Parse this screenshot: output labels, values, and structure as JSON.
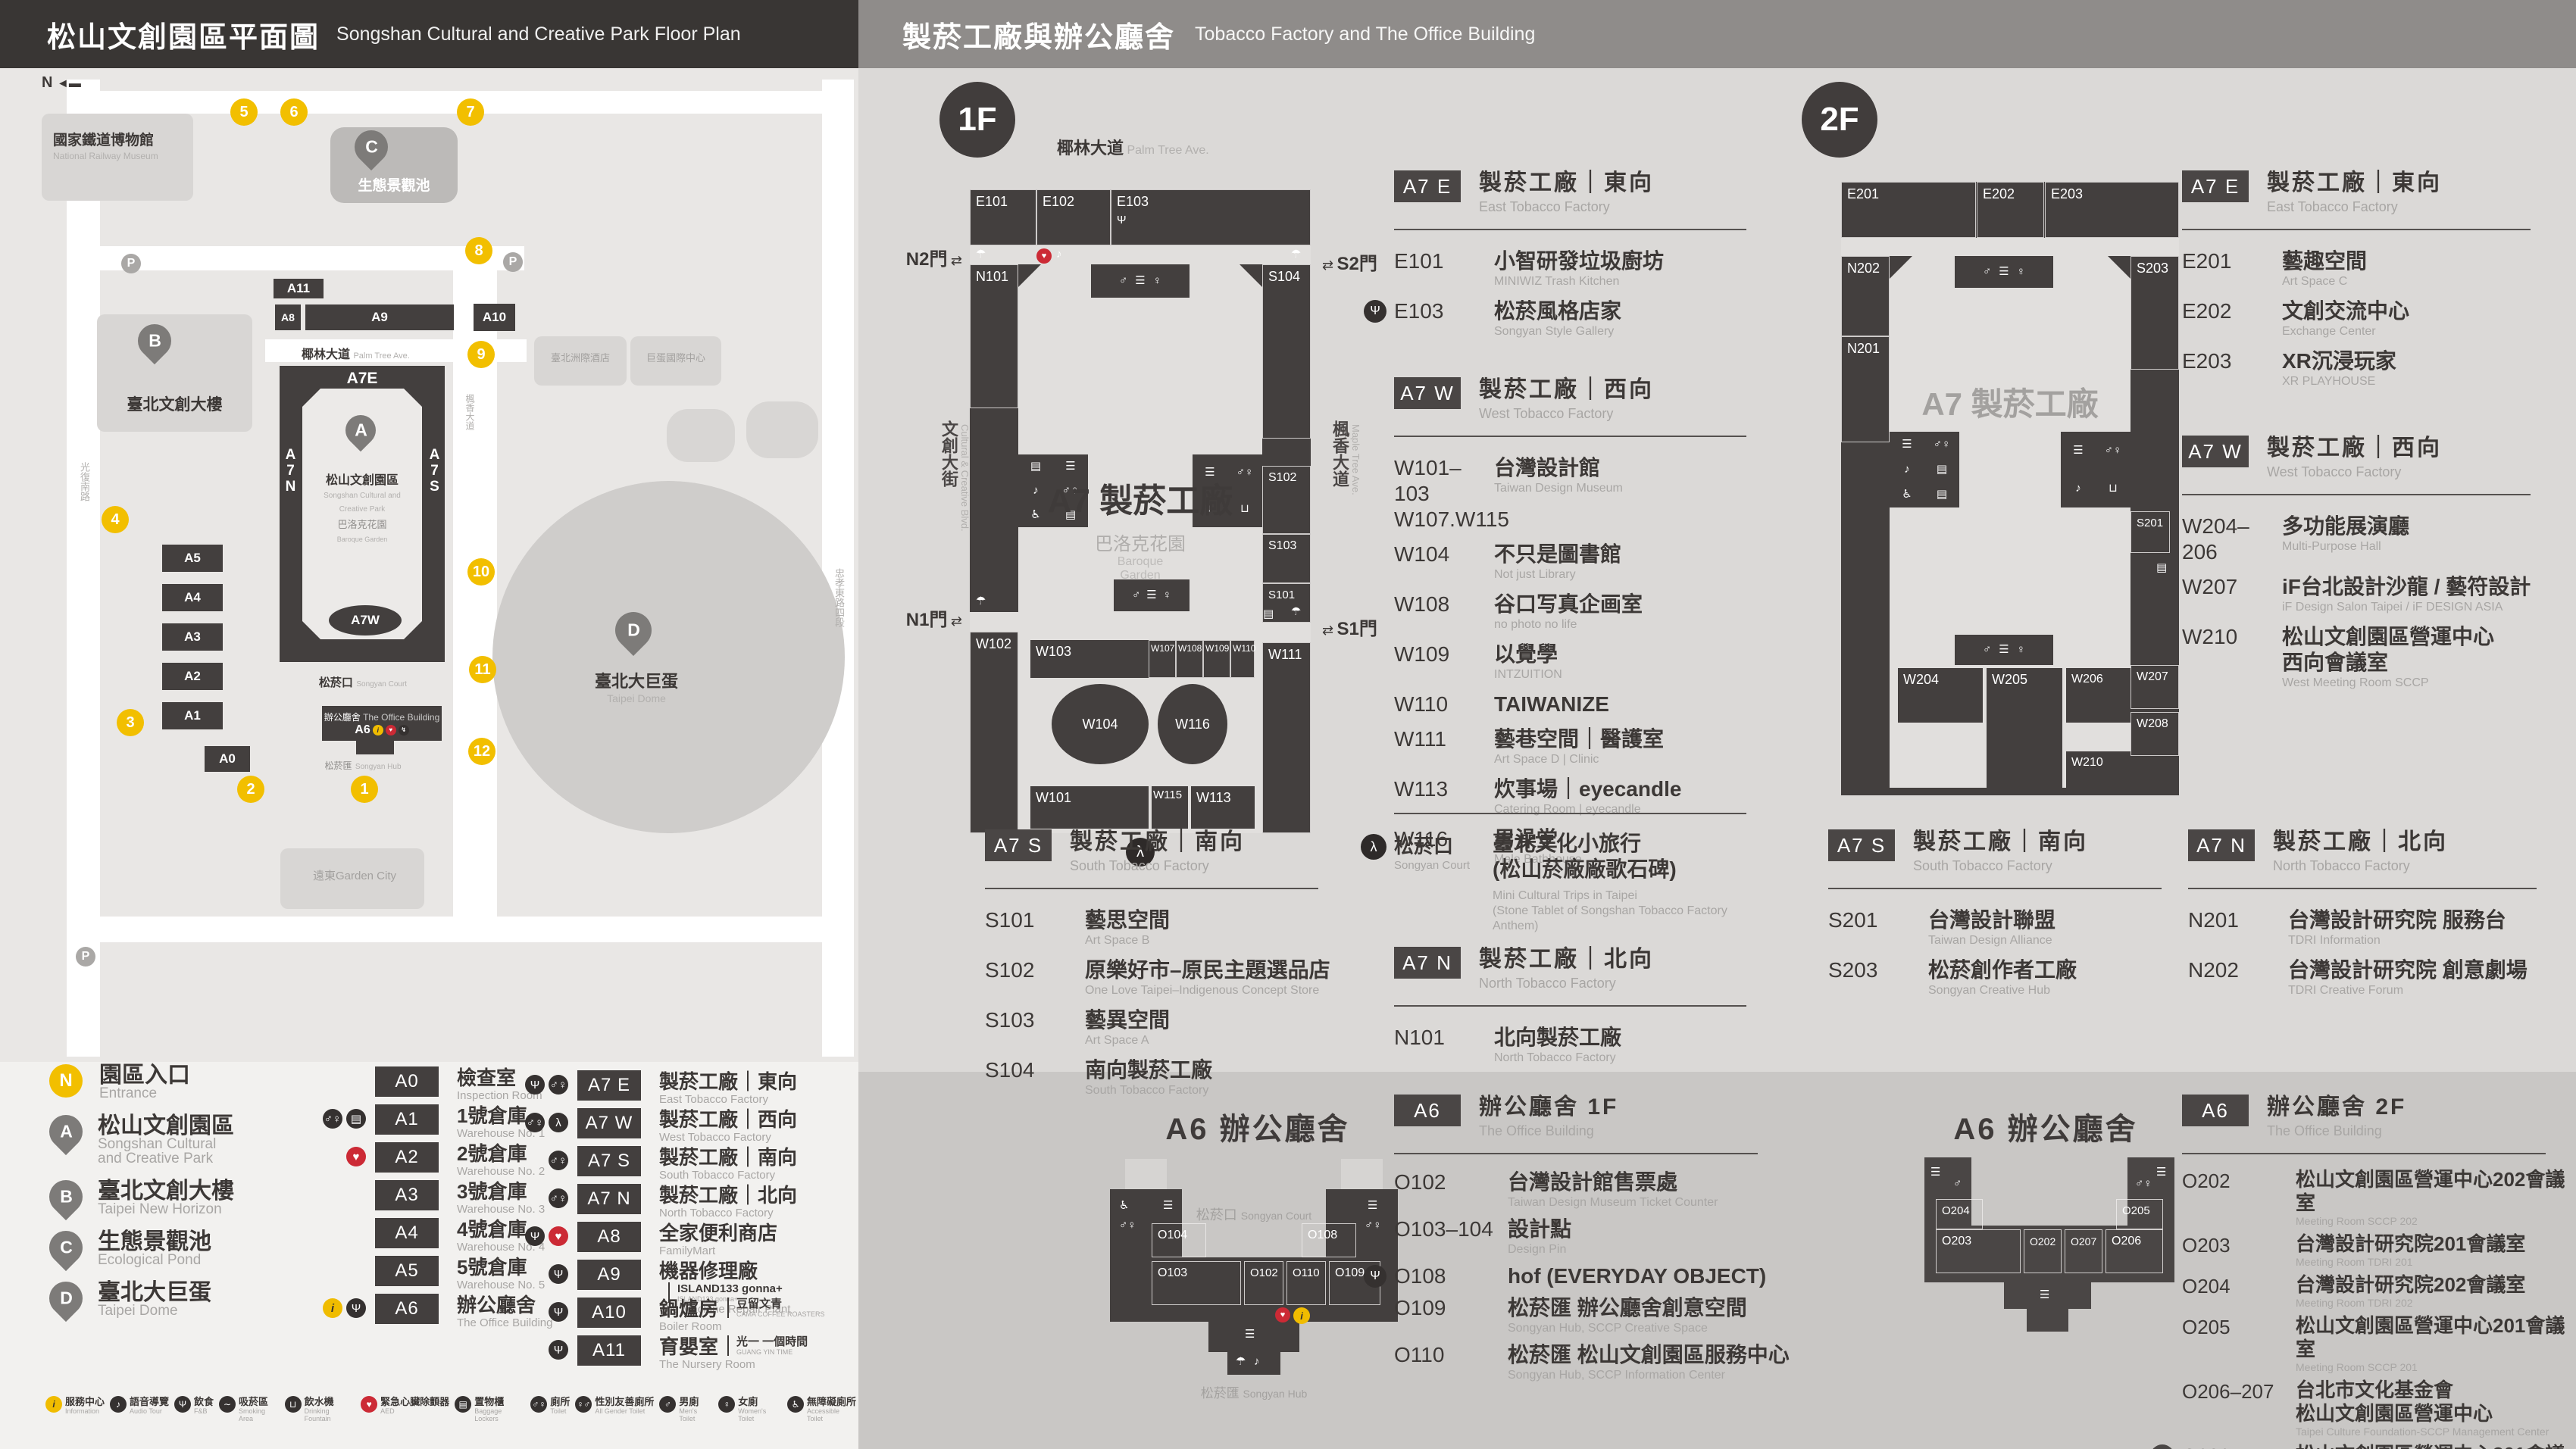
{
  "header_left": {
    "title_zh": "松山文創園區平面圖",
    "title_en": "Songshan Cultural and Creative Park Floor Plan"
  },
  "header_right": {
    "title_zh": "製菸工廠與辦公廳舍",
    "title_en": "Tobacco Factory and The Office Building"
  },
  "colors": {
    "dark": "#433f3e",
    "panel": "#dbd9d7",
    "panel_dark": "#c9c7c5",
    "yellow": "#f2bf00",
    "red": "#cc2a35",
    "header_right": "#8f8c8a"
  },
  "park_map": {
    "compass": "N",
    "railway_zh": "國家鐵道博物館",
    "railway_en": "National Railway Museum",
    "streets": {
      "palm_zh": "椰林大道",
      "palm_en": "Palm Tree Ave.",
      "guangfu": "光復南路",
      "zhongxiao": "忠孝東路四段",
      "maple_zh": "楓香大道",
      "maple_en": "Maple Tree Ave."
    },
    "blocks": {
      "a11": "A11",
      "a8": "A8",
      "a9": "A9",
      "a10": "A10",
      "a7e": "A7E",
      "a7w": "A7W",
      "a7n": "A7N",
      "a7s": "A7S",
      "a5": "A5",
      "a4": "A4",
      "a3": "A3",
      "a2": "A2",
      "a1": "A1",
      "a0": "A0",
      "a6": "A6"
    },
    "pond_label": "生態景觀池",
    "b_label": "臺北文創大樓",
    "a_label_zh": "松山文創園區",
    "a_label_en": "Songshan Cultural and\nCreative Park",
    "garden_zh": "巴洛克花園",
    "garden_en": "Baroque Garden",
    "court_zh": "松菸口",
    "court_en": "Songyan Court",
    "office_zh": "辦公廳舍",
    "office_en": "The Office Building",
    "hub_zh": "松菸匯",
    "hub_en": "Songyan Hub",
    "dome_zh": "臺北大巨蛋",
    "dome_en": "Taipei Dome",
    "hotel1": "臺北洲際酒店",
    "hotel2": "巨蛋國際中心",
    "garden_city": "遠東Garden City",
    "pins": {
      "a": "A",
      "b": "B",
      "c": "C",
      "d": "D"
    },
    "entrances": [
      "1",
      "2",
      "3",
      "4",
      "5",
      "6",
      "7",
      "8",
      "9",
      "10",
      "11",
      "12"
    ]
  },
  "legend": {
    "entrance": {
      "symbol": "N",
      "zh": "園區入口",
      "en": "Entrance"
    },
    "places": [
      {
        "pin": "A",
        "zh": "松山文創園區",
        "en": "Songshan Cultural\nand Creative Park"
      },
      {
        "pin": "B",
        "zh": "臺北文創大樓",
        "en": "Taipei New Horizon"
      },
      {
        "pin": "C",
        "zh": "生態景觀池",
        "en": "Ecological Pond"
      },
      {
        "pin": "D",
        "zh": "臺北大巨蛋",
        "en": "Taipei Dome"
      }
    ],
    "col1": [
      {
        "badge": "A0",
        "zh": "檢查室",
        "en": "Inspection Room",
        "icons": []
      },
      {
        "badge": "A1",
        "zh": "1號倉庫",
        "en": "Warehouse No. 1",
        "icons": [
          {
            "g": "▤",
            "c": "dark"
          },
          {
            "g": "♂♀",
            "c": "dark"
          }
        ]
      },
      {
        "badge": "A2",
        "zh": "2號倉庫",
        "en": "Warehouse No. 2",
        "icons": [
          {
            "g": "♥",
            "c": "red"
          }
        ]
      },
      {
        "badge": "A3",
        "zh": "3號倉庫",
        "en": "Warehouse No. 3",
        "icons": []
      },
      {
        "badge": "A4",
        "zh": "4號倉庫",
        "en": "Warehouse No. 4",
        "icons": []
      },
      {
        "badge": "A5",
        "zh": "5號倉庫",
        "en": "Warehouse No. 5",
        "icons": []
      },
      {
        "badge": "A6",
        "zh": "辦公廳舍",
        "en": "The Office Building",
        "icons": [
          {
            "g": "Ψ",
            "c": "dark"
          },
          {
            "g": "i",
            "c": "yellow"
          }
        ]
      }
    ],
    "col2": [
      {
        "badge": "A7 E",
        "zh": "製菸工廠｜東向",
        "en": "East Tobacco Factory",
        "icons": [
          {
            "g": "♂♀",
            "c": "dark"
          },
          {
            "g": "Ψ",
            "c": "dark"
          }
        ]
      },
      {
        "badge": "A7 W",
        "zh": "製菸工廠｜西向",
        "en": "West Tobacco Factory",
        "icons": [
          {
            "g": "λ",
            "c": "dark"
          },
          {
            "g": "♂♀",
            "c": "dark"
          }
        ]
      },
      {
        "badge": "A7 S",
        "zh": "製菸工廠｜南向",
        "en": "South Tobacco Factory",
        "icons": [
          {
            "g": "♂♀",
            "c": "dark"
          }
        ]
      },
      {
        "badge": "A7 N",
        "zh": "製菸工廠｜北向",
        "en": "North Tobacco Factory",
        "icons": [
          {
            "g": "♂♀",
            "c": "dark"
          }
        ]
      },
      {
        "badge": "A8",
        "zh": "全家便利商店",
        "en": "FamilyMart",
        "icons": [
          {
            "g": "♥",
            "c": "red"
          },
          {
            "g": "Ψ",
            "c": "dark"
          }
        ]
      },
      {
        "badge": "A9",
        "zh": "機器修理廠",
        "en": "The Machine Repair Plant",
        "brand_zh": "ISLAND133 gonna+",
        "brand_en": "ISLAND133 gonna+",
        "icons": [
          {
            "g": "Ψ",
            "c": "dark"
          }
        ]
      },
      {
        "badge": "A10",
        "zh": "鍋爐房",
        "en": "Boiler Room",
        "brand_zh": "豆留文青",
        "brand_en": "CAMA COFFEE ROASTERS",
        "icons": [
          {
            "g": "Ψ",
            "c": "dark"
          }
        ]
      },
      {
        "badge": "A11",
        "zh": "育嬰室",
        "en": "The Nursery Room",
        "brand_zh": "光一 一個時間",
        "brand_en": "GUANG YIN TIME",
        "icons": [
          {
            "g": "Ψ",
            "c": "dark"
          }
        ]
      }
    ]
  },
  "amenities_left": [
    {
      "zh": "服務中心",
      "en": "Information",
      "g": "i",
      "c": "yellow"
    },
    {
      "zh": "語音導覽",
      "en": "Audio Tour",
      "g": "♪",
      "c": "dark"
    },
    {
      "zh": "飲食",
      "en": "F&B",
      "g": "Ψ",
      "c": "dark"
    },
    {
      "zh": "吸菸區",
      "en": "Smoking Area",
      "g": "∼",
      "c": "dark"
    },
    {
      "zh": "飲水機",
      "en": "Drinking Fountain",
      "g": "⊔",
      "c": "dark"
    },
    {
      "zh": "緊急心臟除顫器",
      "en": "AED",
      "g": "♥",
      "c": "red"
    },
    {
      "zh": "置物櫃",
      "en": "Baggage Lockers",
      "g": "▤",
      "c": "dark"
    },
    {
      "zh": "廁所",
      "en": "Toilet",
      "g": "♂♀",
      "c": "dark"
    },
    {
      "zh": "性別友善廁所",
      "en": "All Gender Toilet",
      "g": "♀♂",
      "c": "dark"
    },
    {
      "zh": "男廁",
      "en": "Men's Toilet",
      "g": "♂",
      "c": "dark"
    },
    {
      "zh": "女廁",
      "en": "Women's Toilet",
      "g": "♀",
      "c": "dark"
    },
    {
      "zh": "無障礙廁所",
      "en": "Accessible Toilet",
      "g": "♿",
      "c": "dark"
    }
  ],
  "amenities_right": [
    {
      "zh": "哺集乳室",
      "en": "Breastfeeding Room",
      "g": "♡",
      "c": "dark"
    },
    {
      "zh": "共享行動電源",
      "en": "Power Bank Rental",
      "g": "↯",
      "c": "dark"
    },
    {
      "zh": "共享傘",
      "en": "Umbrella Rental",
      "g": "☂",
      "c": "dark"
    },
    {
      "zh": "階梯",
      "en": "Stairs",
      "g": "☰",
      "c": "dark"
    },
    {
      "zh": "貨梯",
      "en": "Elevator For Goods",
      "g": "▣",
      "c": "dark"
    },
    {
      "zh": "無障礙電梯",
      "en": "Accessible Elevator",
      "g": "♿",
      "c": "dark"
    },
    {
      "zh": "臺北文化小旅行",
      "note": "(松山菸廠廠歌石碑)",
      "en": "Mini Cultural Trips in Taipei\n(Stone Tablet of Songshan Tobacco Factory Anthem)",
      "g": "λ",
      "c": "dark"
    }
  ],
  "floor1": {
    "badge": "1F",
    "map": {
      "street_top_zh": "椰林大道",
      "street_top_en": "Palm Tree Ave.",
      "street_left_zh": "文創大街",
      "street_left_en": "Cultural & Creative Blvd.",
      "street_right_zh": "楓香大道",
      "street_right_en": "Maple Tree Ave.",
      "gates": {
        "n2": "N2門",
        "s2": "S2門",
        "n1": "N1門",
        "s1": "S1門"
      },
      "bld_label": "A7 製菸工廠",
      "garden_zh": "巴洛克花園",
      "garden_en": "Baroque\nGarden",
      "rooms": {
        "e101": "E101",
        "e102": "E102",
        "e103": "E103",
        "n101": "N101",
        "s104": "S104",
        "s103": "S103",
        "s102": "S102",
        "s101": "S101",
        "w101": "W101",
        "w102": "W102",
        "w103": "W103",
        "w104": "W104",
        "w107": "W107",
        "w108": "W108",
        "w109": "W109",
        "w110": "W110",
        "w111": "W111",
        "w113": "W113",
        "w115": "W115",
        "w116": "W116"
      }
    },
    "a7e": {
      "badge": "A7 E",
      "zh": "製菸工廠｜東向",
      "en": "East Tobacco Factory",
      "rooms": [
        {
          "id": "E101",
          "zh": "小智研發垃圾廚坊",
          "en": "MINIWIZ Trash Kitchen"
        },
        {
          "id": "E103",
          "zh": "松菸風格店家",
          "en": "Songyan Style Gallery",
          "pre": "Ψ"
        }
      ]
    },
    "a7w": {
      "badge": "A7 W",
      "zh": "製菸工廠｜西向",
      "en": "West Tobacco Factory",
      "rooms": [
        {
          "id": "W101–103\nW107.W115",
          "zh": "台灣設計館",
          "en": "Taiwan Design Museum"
        },
        {
          "id": "W104",
          "zh": "不只是圖書館",
          "en": "Not just Library"
        },
        {
          "id": "W108",
          "zh": "谷口写真企画室",
          "en": "no photo no life"
        },
        {
          "id": "W109",
          "zh": "以覺學",
          "en": "INTZUITION"
        },
        {
          "id": "W110",
          "zh": "TAIWANIZE"
        },
        {
          "id": "W111",
          "zh": "藝巷空間｜醫護室",
          "en": "Art Space D | Clinic"
        },
        {
          "id": "W113",
          "zh": "炊事場｜eyecandle",
          "en": "Catering Room | eyecandle"
        },
        {
          "id": "W116",
          "zh": "男澡堂",
          "en": "Male Bathhouse"
        }
      ]
    },
    "court": {
      "label_zh": "松菸口",
      "label_en": "Songyan Court",
      "zh": "臺北文化小旅行\n(松山菸廠廠歌石碑)",
      "en": "Mini Cultural Trips in Taipei\n(Stone Tablet of Songshan Tobacco Factory Anthem)",
      "icon": "λ"
    },
    "a7s": {
      "badge": "A7 S",
      "zh": "製菸工廠｜南向",
      "en": "South Tobacco Factory",
      "rooms": [
        {
          "id": "S101",
          "zh": "藝思空間",
          "en": "Art Space B"
        },
        {
          "id": "S102",
          "zh": "原樂好市–原民主題選品店",
          "en": "One Love Taipei–Indigenous Concept Store"
        },
        {
          "id": "S103",
          "zh": "藝異空間",
          "en": "Art Space A"
        },
        {
          "id": "S104",
          "zh": "南向製菸工廠",
          "en": "South Tobacco Factory"
        }
      ]
    },
    "a7n": {
      "badge": "A7 N",
      "zh": "製菸工廠｜北向",
      "en": "North Tobacco Factory",
      "rooms": [
        {
          "id": "N101",
          "zh": "北向製菸工廠",
          "en": "North Tobacco Factory"
        }
      ]
    },
    "a6": {
      "map_title": "A6 辦公廳舍",
      "court_zh": "松菸口",
      "court_en": "Songyan Court",
      "hub_zh": "松菸匯",
      "hub_en": "Songyan Hub",
      "map_rooms": {
        "o104": "O104",
        "o103": "O103",
        "o102": "O102",
        "o110": "O110",
        "o109": "O109",
        "o108": "O108"
      },
      "badge": "A6",
      "zh": "辦公廳舍 1F",
      "en": "The Office Building",
      "rooms": [
        {
          "id": "O102",
          "zh": "台灣設計館售票處",
          "en": "Taiwan Design Museum Ticket Counter"
        },
        {
          "id": "O103–104",
          "zh": "設計點",
          "en": "Design Pin"
        },
        {
          "id": "O108",
          "zh": "hof (EVERYDAY OBJECT)",
          "pre": "Ψ"
        },
        {
          "id": "O109",
          "zh": "松菸匯 辦公廳舍創意空間",
          "en": "Songyan Hub, SCCP Creative Space"
        },
        {
          "id": "O110",
          "zh": "松菸匯 松山文創園區服務中心",
          "en": "Songyan Hub, SCCP Information Center"
        }
      ]
    }
  },
  "floor2": {
    "badge": "2F",
    "map": {
      "bld_label": "A7 製菸工廠",
      "rooms": {
        "e201": "E201",
        "e202": "E202",
        "e203": "E203",
        "n202": "N202",
        "n201": "N201",
        "s203": "S203",
        "s201": "S201",
        "w204": "W204",
        "w205": "W205",
        "w206": "W206",
        "w207": "W207",
        "w208": "W208",
        "w210": "W210"
      }
    },
    "a7e": {
      "badge": "A7 E",
      "zh": "製菸工廠｜東向",
      "en": "East Tobacco Factory",
      "rooms": [
        {
          "id": "E201",
          "zh": "藝趣空間",
          "en": "Art Space C"
        },
        {
          "id": "E202",
          "zh": "文創交流中心",
          "en": "Exchange Center"
        },
        {
          "id": "E203",
          "zh": "XR沉浸玩家",
          "en": "XR PLAYHOUSE"
        }
      ]
    },
    "a7w": {
      "badge": "A7 W",
      "zh": "製菸工廠｜西向",
      "en": "West Tobacco Factory",
      "rooms": [
        {
          "id": "W204–206",
          "zh": "多功能展演廳",
          "en": "Multi-Purpose Hall"
        },
        {
          "id": "W207",
          "zh": "iF台北設計沙龍 / 藝符設計",
          "en": "iF Design Salon Taipei / iF DESIGN ASIA"
        },
        {
          "id": "W210",
          "zh": "松山文創園區營運中心\n西向會議室",
          "en": "West Meeting Room SCCP"
        }
      ]
    },
    "a7s": {
      "badge": "A7 S",
      "zh": "製菸工廠｜南向",
      "en": "South Tobacco Factory",
      "rooms": [
        {
          "id": "S201",
          "zh": "台灣設計聯盟",
          "en": "Taiwan Design Alliance"
        },
        {
          "id": "S203",
          "zh": "松菸創作者工廠",
          "en": "Songyan Creative Hub"
        }
      ]
    },
    "a7n": {
      "badge": "A7 N",
      "zh": "製菸工廠｜北向",
      "en": "North Tobacco Factory",
      "rooms": [
        {
          "id": "N201",
          "zh": "台灣設計研究院 服務台",
          "en": "TDRI Information"
        },
        {
          "id": "N202",
          "zh": "台灣設計研究院 創意劇場",
          "en": "TDRI Creative Forum"
        }
      ]
    },
    "a6": {
      "map_title": "A6 辦公廳舍",
      "map_rooms": {
        "o204": "O204",
        "o203": "O203",
        "o202": "O202",
        "o207": "O207",
        "o206": "O206",
        "o205": "O205"
      },
      "badge": "A6",
      "zh": "辦公廳舍 2F",
      "en": "The Office Building",
      "rooms": [
        {
          "id": "O202",
          "zh": "松山文創園區營運中心202會議室",
          "en": "Meeting Room SCCP 202"
        },
        {
          "id": "O203",
          "zh": "台灣設計研究院201會議室",
          "en": "Meeting Room TDRI 201"
        },
        {
          "id": "O204",
          "zh": "台灣設計研究院202會議室",
          "en": "Meeting Room TDRI 202"
        },
        {
          "id": "O205",
          "zh": "松山文創園區營運中心201會議室",
          "en": "Meeting Room SCCP 201"
        },
        {
          "id": "O206–207",
          "zh": "台北市文化基金會\n松山文創園區營運中心",
          "en": "Taipei Culture Foundation-SCCP Management Center"
        },
        {
          "id": "O302",
          "zh": "松山文創園區營運中心301會議室",
          "en": "Meeting Room SCCP 301",
          "fbadge": "3F"
        }
      ]
    }
  }
}
